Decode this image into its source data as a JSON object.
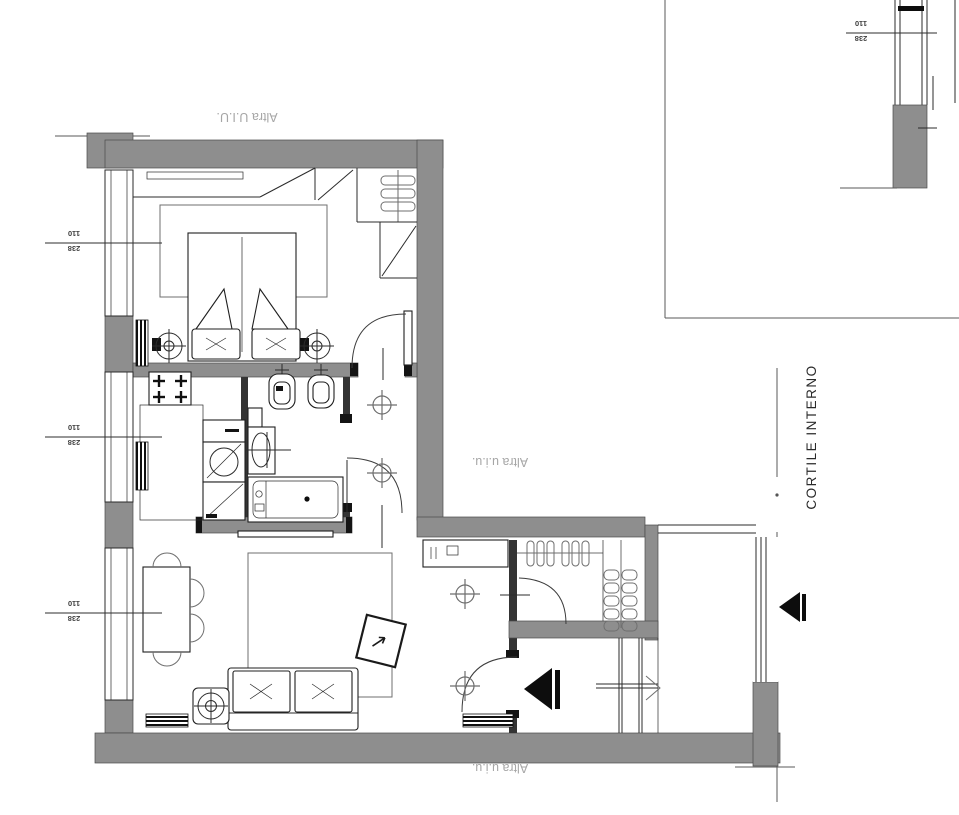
{
  "labels": {
    "adjacent_unit_top": "Altra U.I.U.",
    "adjacent_unit_right": "Altra u.i.u.",
    "adjacent_unit_bottom": "Altra u.i.u.",
    "courtyard": "CORTILE INTERNO"
  },
  "dimensions": {
    "window_width": "110",
    "window_height": "238"
  },
  "colors": {
    "wall": "#8e8e8e",
    "muted_label": "#a6a6a6",
    "dim_text": "#3d3d3d"
  }
}
